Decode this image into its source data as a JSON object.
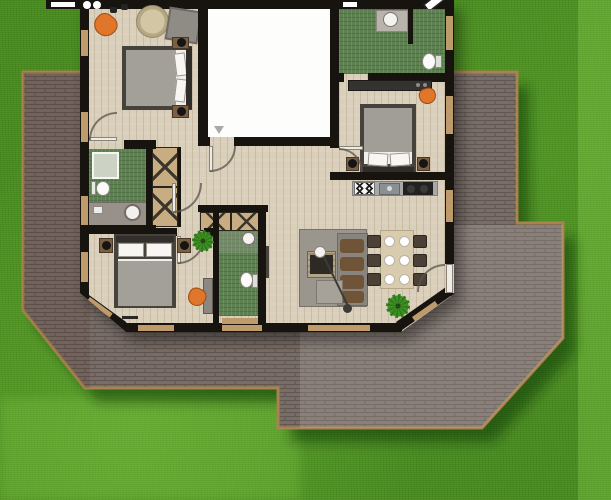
{
  "scene": {
    "kind": "architectural-floor-plan-top-view",
    "environment": {
      "lawn": "textured green grass with lighter mowing stripes on right edge and bottom-left",
      "terrace": "brick-paved patio wrapping left, bottom and right of house, stepped extension to lower right, chamfered corners, tan edging"
    },
    "house": {
      "shape": "rectangular with chamfered bottom-left and bottom-right corners, black walls, light wood plank flooring",
      "rooms": [
        {
          "name": "bedroom-top-left",
          "furniture": [
            "double-bed-pillows-right",
            "nightstand-with-lamp-x2",
            "orange-corner-chair",
            "round-rug",
            "gray-square-rug",
            "wall-speakers"
          ]
        },
        {
          "name": "empty-white-room-top-center",
          "furniture": [
            "vent-symbol"
          ],
          "note": "white floor, door opening at bottom-left"
        },
        {
          "name": "bathroom-top-right",
          "furniture": [
            "corner-shower",
            "toilet"
          ],
          "floor": "green-tile"
        },
        {
          "name": "bedroom-right",
          "furniture": [
            "double-bed-pillows-bottom",
            "nightstand-with-lamp-x2",
            "desk-dresser",
            "orange-chair"
          ]
        },
        {
          "name": "kitchen-dining-living",
          "furniture": [
            "kitchen-counter",
            "four-burner-stove",
            "sink",
            "black-cooktop",
            "dining-table",
            "dining-chair-x6",
            "place-setting-x6",
            "gray-rug",
            "tv-sideboard",
            "l-shaped-sofa-brown-cushions",
            "ottoman",
            "arc-floor-lamp",
            "potted-plant",
            "terrace-door"
          ]
        },
        {
          "name": "hallway-center",
          "furniture": [
            "wardrobe-x-symbol-vertical",
            "wardrobe-x-symbol-horizontal",
            "interior-doors"
          ]
        },
        {
          "name": "bathroom-left",
          "furniture": [
            "shower",
            "toilet",
            "vanity-with-round-sink"
          ],
          "floor": "green-tile"
        },
        {
          "name": "bathroom-center-bottom",
          "furniture": [
            "shower-head",
            "toilet"
          ],
          "floor": "green-tile"
        },
        {
          "name": "bedroom-bottom-left",
          "furniture": [
            "double-bed-pillows-top",
            "nightstand-with-lamp-x2",
            "desk",
            "orange-chair",
            "potted-plant"
          ]
        }
      ]
    }
  },
  "palette": {
    "grass": "#47891f",
    "grass_light_stripe": "#7cc24a",
    "grass_shadow": "#163c0c",
    "terrace_brick": "#786d68",
    "terrace_joint": "#615650",
    "terrace_edge": "#a8824f",
    "wall_black": "#17130f",
    "wood_floor": "#d9cfba",
    "white_room": "#fdfdfc",
    "bath_tile_green": "#5d8050",
    "window_tan": "#bf9a6a",
    "accent_orange": "#e0762a",
    "bed_gray": "#a3a099",
    "sofa_gray": "#89857e",
    "cushion_brown": "#6f5438",
    "closet_tan": "#c9ad82"
  }
}
